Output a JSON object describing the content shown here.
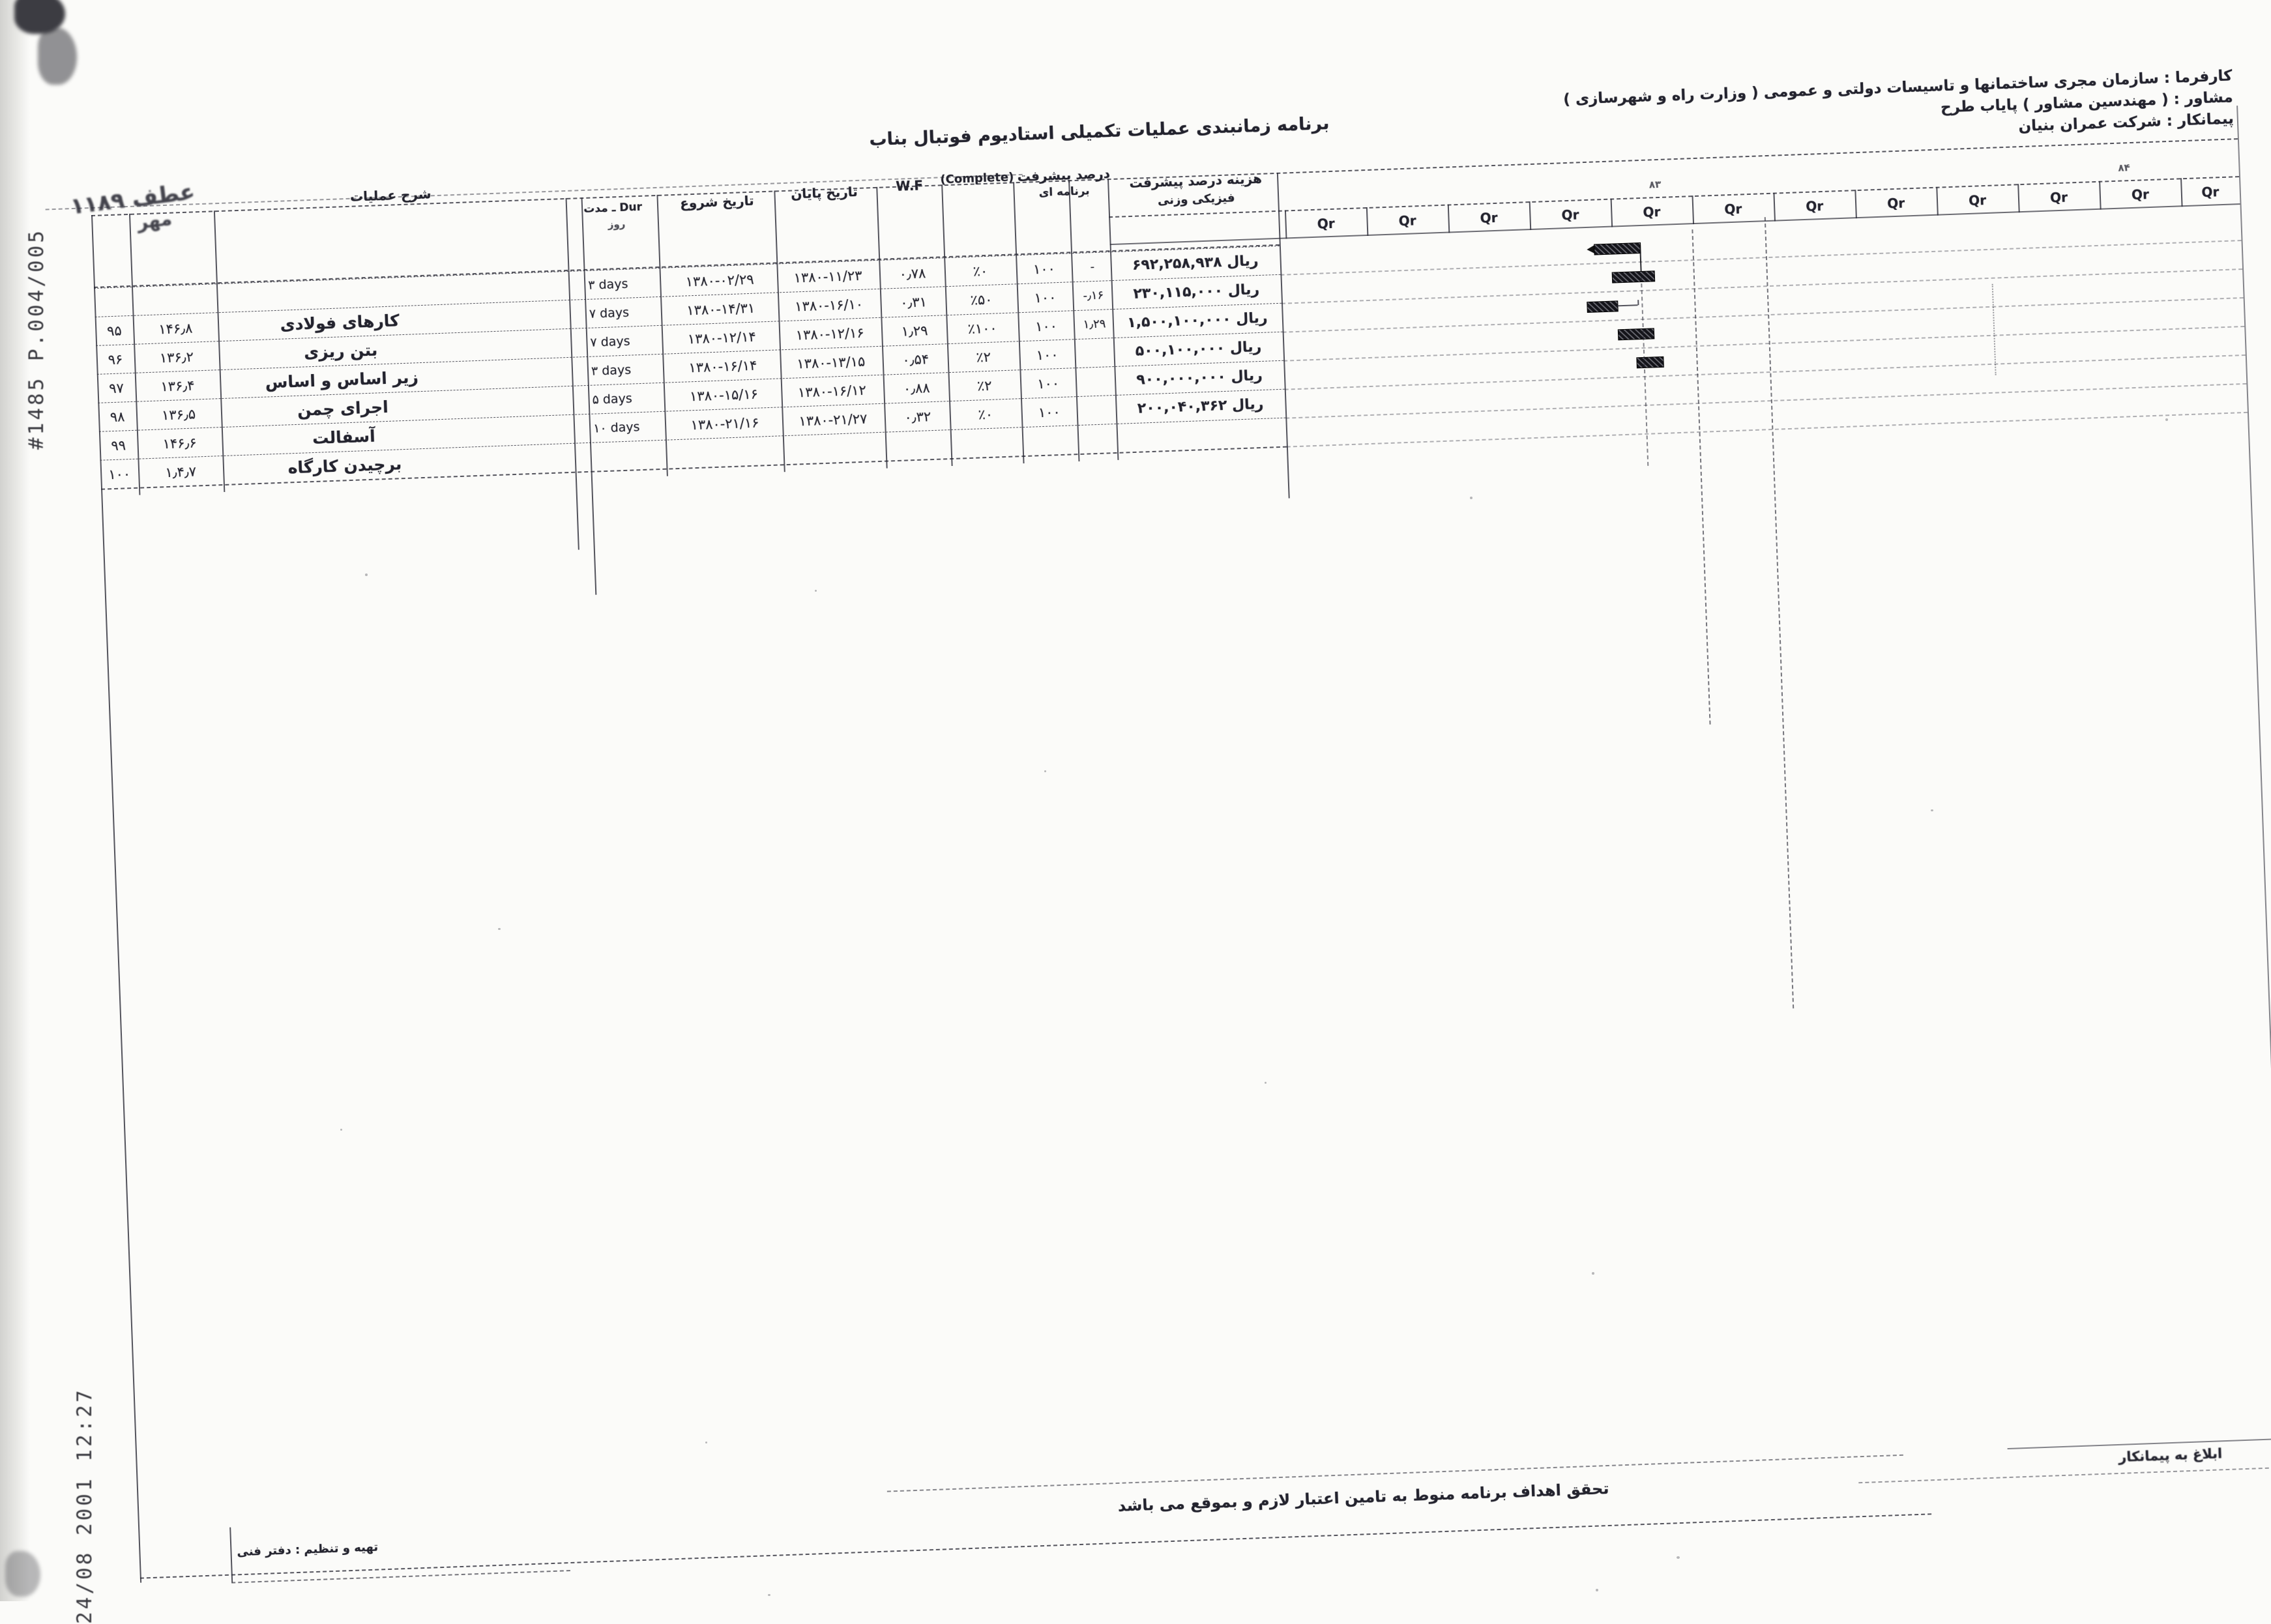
{
  "fax": {
    "id": "#1485 P.004/005",
    "timestamp": "24/08 2001    12:27"
  },
  "header": {
    "client": "کارفرما : سازمان مجری ساختمانها و تاسیسات دولتی و عمومی ( وزارت راه و شهرسازی )",
    "consultant": "مشاور : ( مهندسین مشاور ) پایاب طرح",
    "contractor": "پیمانکار : شرکت عمران بنیان",
    "title": "برنامه زمانبندی عملیات تکمیلی استادیوم فوتبال بناب",
    "stamp_ref": "عطف ۱۱۸۹",
    "stamp_sub": "مهر"
  },
  "table": {
    "col_headers": {
      "desc": "شرح عملیات",
      "dur": "Dur ـ مدت",
      "days_unit": "روز",
      "start": "تاریخ شروع",
      "end": "تاریخ پایان",
      "wf": "W.F",
      "complete": "(Complete)",
      "prog_line1": "درصد پیشرفت",
      "prog_line2": "برنامه ای",
      "cost_line1": "هزینه درصد پیشرفت",
      "cost_line2": "فیزیکی وزنی"
    },
    "rows": [
      {
        "no": "",
        "code": "",
        "desc": "",
        "days": "۳ days",
        "start": "۱۳۸۰-۰۲/۲۹",
        "end": "۱۳۸۰-۱۱/۲۳",
        "wf": "۰٫۷۸",
        "complete": "٪۰",
        "base": "۱۰۰",
        "dev": "-",
        "amount": "ریال ۶۹۲,۲۵۸,۹۳۸"
      },
      {
        "no": "۹۵",
        "code": "۱۴۶٫۸",
        "desc": "کارهای فولادی",
        "days": "۷ days",
        "start": "۱۳۸۰-۱۴/۳۱",
        "end": "۱۳۸۰-۱۶/۱۰",
        "wf": "۰٫۳۱",
        "complete": "٪۵۰",
        "base": "۱۰۰",
        "dev": "-٫۱۶",
        "amount": "ریال ۲۳۰,۱۱۵,۰۰۰"
      },
      {
        "no": "۹۶",
        "code": "۱۳۶٫۲",
        "desc": "بتن ریزی",
        "days": "۷ days",
        "start": "۱۳۸۰-۱۲/۱۴",
        "end": "۱۳۸۰-۱۲/۱۶",
        "wf": "۱٫۲۹",
        "complete": "٪۱۰۰",
        "base": "۱۰۰",
        "dev": "۱٫۲۹",
        "amount": "ریال ۱,۵۰۰,۱۰۰,۰۰۰"
      },
      {
        "no": "۹۷",
        "code": "۱۳۶٫۴",
        "desc": "زیر اساس و اساس",
        "days": "۳ days",
        "start": "۱۳۸۰-۱۶/۱۴",
        "end": "۱۳۸۰-۱۳/۱۵",
        "wf": "۰٫۵۴",
        "complete": "٪۲",
        "base": "۱۰۰",
        "dev": "",
        "amount": "ریال ۵۰۰,۱۰۰,۰۰۰"
      },
      {
        "no": "۹۸",
        "code": "۱۳۶٫۵",
        "desc": "اجرای چمن",
        "days": "۵ days",
        "start": "۱۳۸۰-۱۵/۱۶",
        "end": "۱۳۸۰-۱۶/۱۲",
        "wf": "۰٫۸۸",
        "complete": "٪۲",
        "base": "۱۰۰",
        "dev": "",
        "amount": "ریال ۹۰۰,۰۰۰,۰۰۰"
      },
      {
        "no": "۹۹",
        "code": "۱۴۶٫۶",
        "desc": "آسفالت",
        "days": "۱۰ days",
        "start": "۱۳۸۰-۲۱/۱۶",
        "end": "۱۳۸۰-۲۱/۲۷",
        "wf": "۰٫۳۲",
        "complete": "٪۰",
        "base": "۱۰۰",
        "dev": "",
        "amount": "ریال ۲۰۰,۰۴۰,۳۶۲"
      },
      {
        "no": "۱۰۰",
        "code": "۱٫۴٫۷",
        "desc": "برچیدن کارگاه",
        "days": "",
        "start": "",
        "end": "",
        "wf": "",
        "complete": "",
        "base": "",
        "dev": "",
        "amount": ""
      }
    ]
  },
  "gantt": {
    "quarter_label": "Qr",
    "year_marks": [
      "۸۳",
      "۸۴"
    ]
  },
  "footer": {
    "note": "تحقق اهداف برنامه منوط به تامین اعتبار لازم و بموقع می باشد",
    "prepared_by": "تهیه و تنظیم : دفتر فنی",
    "signoff": "ابلاغ به پیمانکار"
  }
}
